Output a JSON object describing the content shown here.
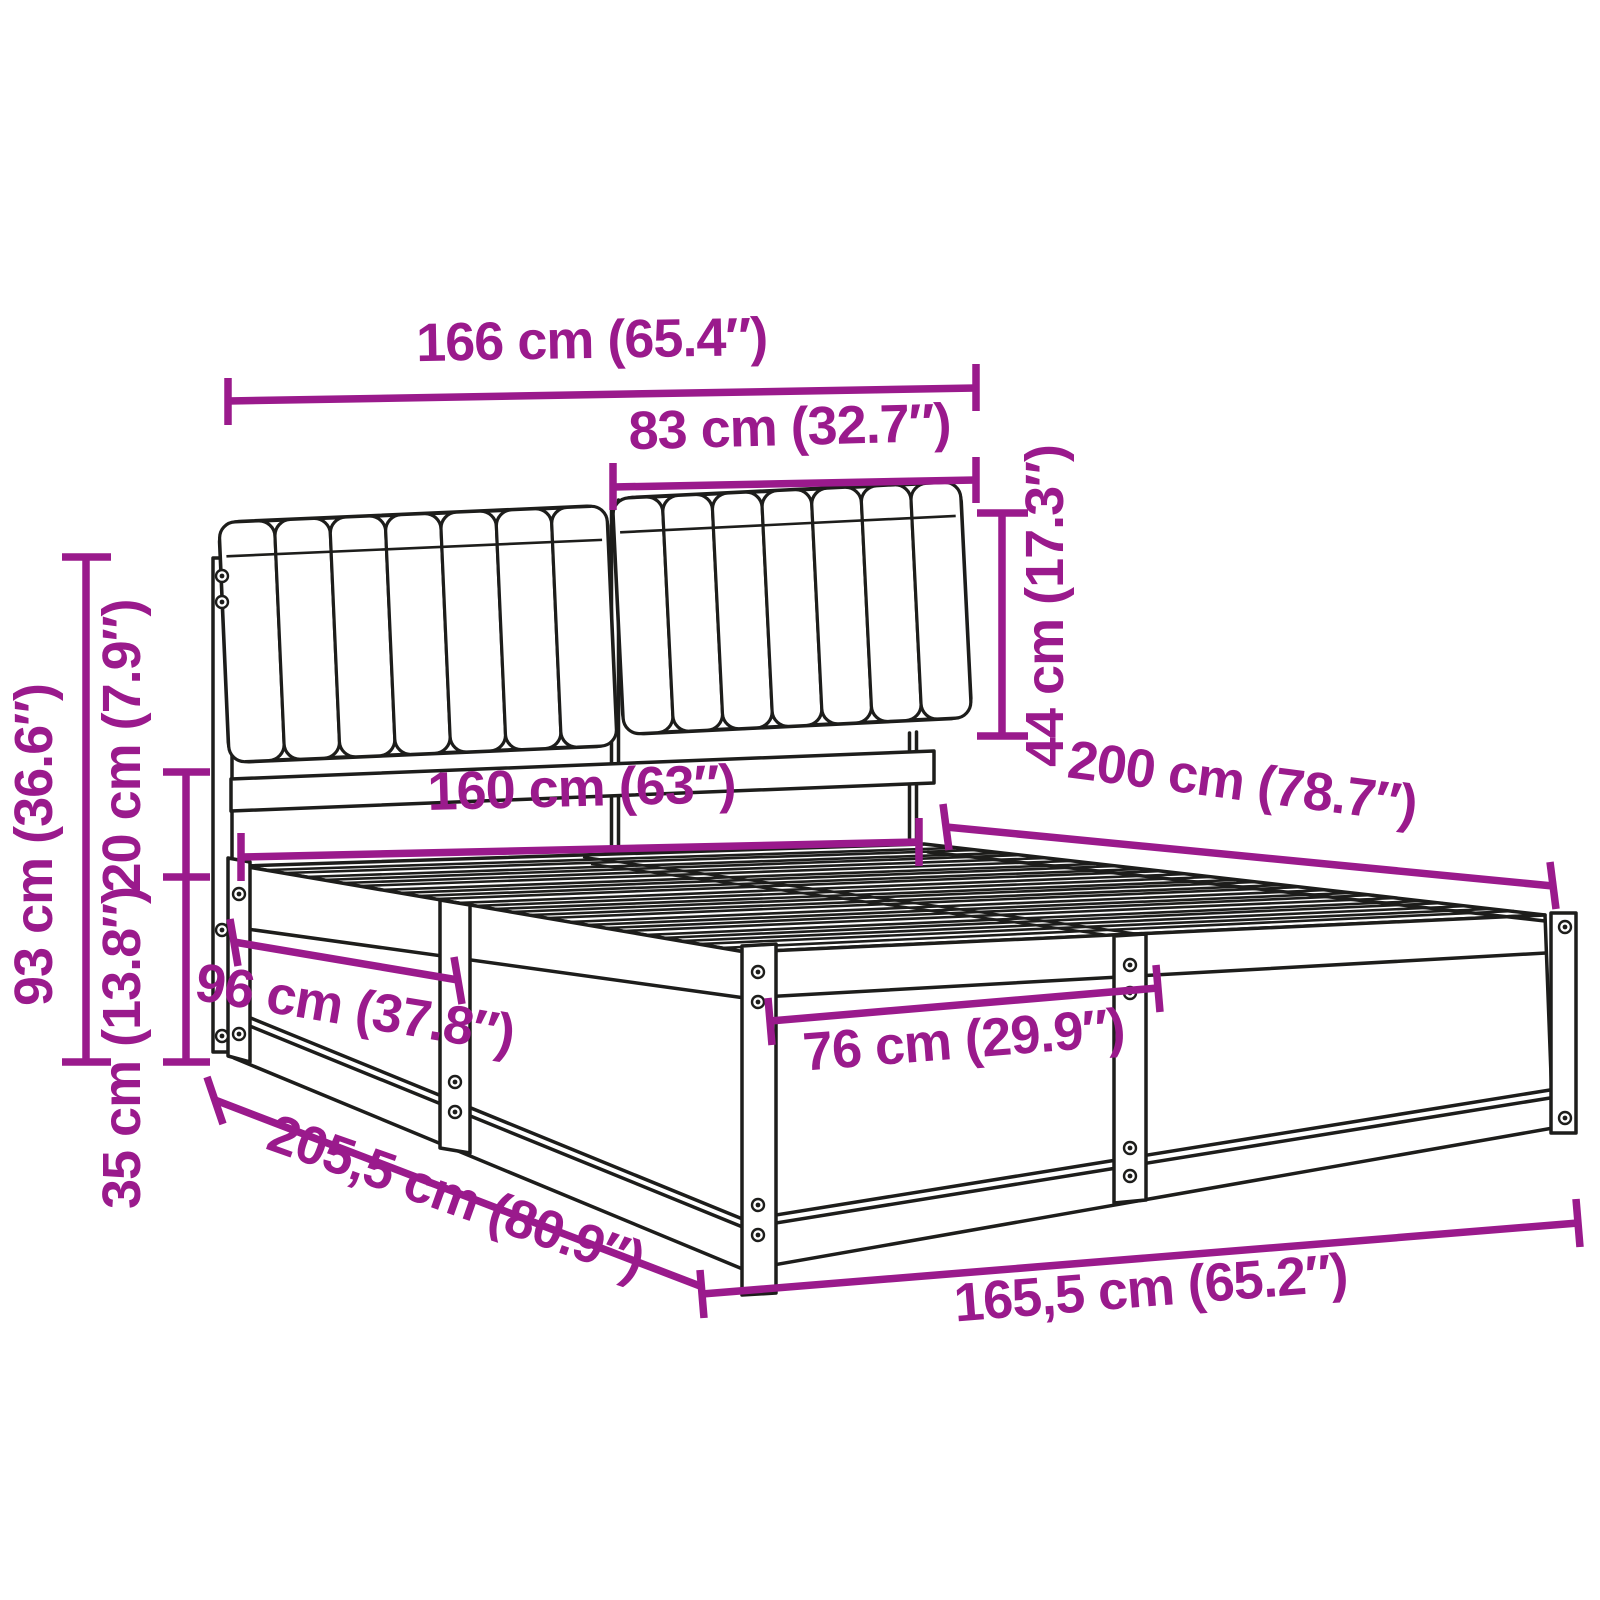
{
  "page": {
    "background": "#ffffff"
  },
  "drawing": {
    "subject": "Bed frame with upholstered two-panel headboard and slatted base - dimension diagram",
    "accent_color": "#9A1A8C",
    "line_color": "#1d1d1b"
  },
  "dims": {
    "overall_width_top": {
      "label": "166 cm (65.4″)"
    },
    "cushion_width": {
      "label": "83 cm (32.7″)"
    },
    "cushion_height": {
      "label": "44 cm (17.3″)"
    },
    "headboard_height": {
      "label": "93 cm (36.6″)"
    },
    "cushion_gap": {
      "label": "20 cm (7.9″)"
    },
    "base_height": {
      "label": "35 cm (13.8″)"
    },
    "bed_width": {
      "label": "160 cm (63″)"
    },
    "bed_length": {
      "label": "200 cm (78.7″)"
    },
    "side_panel_length": {
      "label": "96 cm (37.8″)"
    },
    "foot_panel_width": {
      "label": "76 cm (29.9″)"
    },
    "overall_length": {
      "label": "205,5 cm (80.9″)"
    },
    "overall_width_bottom": {
      "label": "165,5 cm (65.2″)"
    }
  }
}
